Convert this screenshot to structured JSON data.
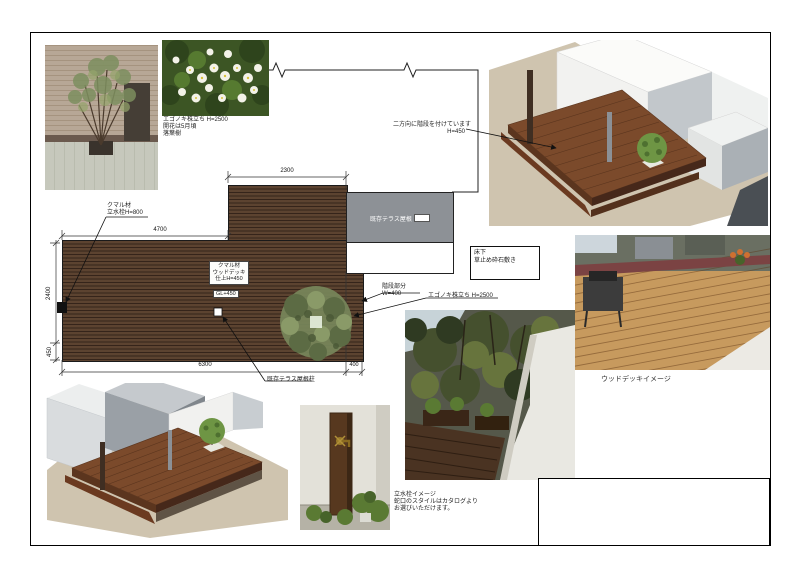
{
  "colors": {
    "deck_wood": "#5c4330",
    "deck_gap": "#35241a",
    "canopy_gray": "#8d9196",
    "ground_tan": "#cfc4af",
    "wood_floor": "#c79a5e",
    "render_deck": "#7b4a2b"
  },
  "top_left": {
    "flower_caption": [
      "エゴノキ株立ち H=2500",
      "開花は5月頃",
      "落葉樹"
    ]
  },
  "plan": {
    "dims": {
      "top": "2300",
      "upper_left": "4700",
      "left": "2400",
      "left_lower": "450",
      "bottom": "6300",
      "bottom_right": "400"
    },
    "tap_label": [
      "クマル材",
      "立水栓H=800"
    ],
    "deck_label": [
      "クマル材",
      "ウッドデッキ",
      "仕上H=450"
    ],
    "deck_level": "GL+450",
    "step_label": [
      "階段部分",
      "W=400"
    ],
    "tree_label": "エゴノキ株立ち H=2500",
    "post_label": "既存テラス屋根柱",
    "canopy_label": "既存テラス屋根",
    "note_box": [
      "床下",
      "草止め砕石敷き"
    ]
  },
  "render_top": {
    "note": [
      "二方向に階段を付けています",
      "H=450"
    ]
  },
  "photo_right": {
    "caption": "ウッドデッキイメージ"
  },
  "tap_photo": {
    "note": [
      "立水栓イメージ",
      "蛇口のスタイルはカタログより",
      "お選びいただけます。"
    ]
  }
}
